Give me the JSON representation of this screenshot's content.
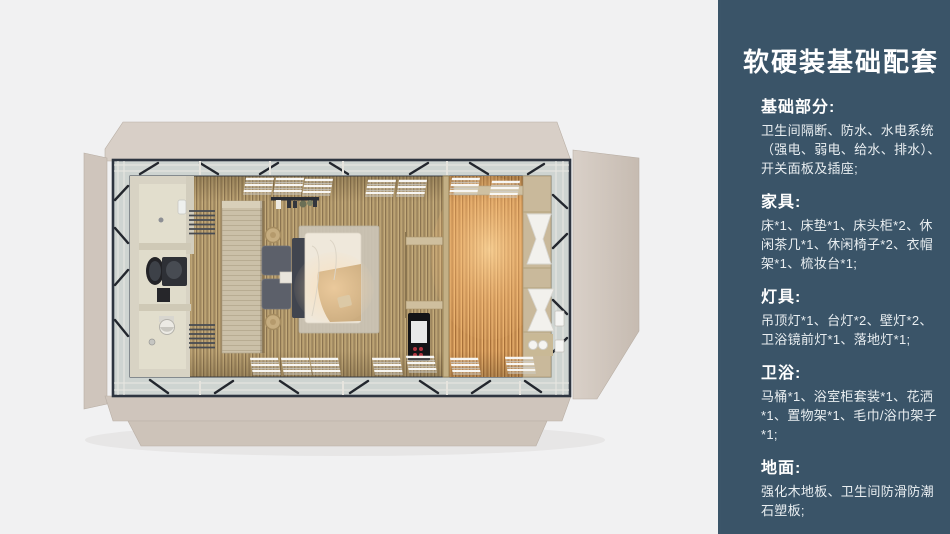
{
  "theme": {
    "canvas_bg": "#f1f1f2",
    "sidebar_bg": "#3a5468",
    "title_color": "#ffffff",
    "body_color": "#e9eef1",
    "flap_beige": "#d8cfc7",
    "flap_beige_dark": "#cfc5bc",
    "steel_frame": "#2e3540",
    "glass_band": "#ced4d1",
    "floor_wood": "#b1986a",
    "floor_warm": "#d0975a",
    "bathroom_wall": "#d8d3c4",
    "wardrobe_wood": "#cbc0a8",
    "bed_duvet": "#efe8db",
    "pillow_dark": "#5c606a",
    "curtain_white": "#f2f1ed"
  },
  "sidebar": {
    "title": "软硬装基础配套",
    "sections": [
      {
        "title": "基础部分:",
        "body": "卫生间隔断、防水、水电系统（强电、弱电、给水、排水）、开关面板及插座;"
      },
      {
        "title": "家具:",
        "body": "床*1、床垫*1、床头柜*2、休闲茶几*1、休闲椅子*2、衣帽架*1、梳妆台*1;"
      },
      {
        "title": "灯具:",
        "body": "吊顶灯*1、台灯*2、壁灯*2、卫浴镜前灯*1、落地灯*1;"
      },
      {
        "title": "卫浴:",
        "body": "马桶*1、浴室柜套装*1、花洒*1、置物架*1、毛巾/浴巾架子*1;"
      },
      {
        "title": "地面:",
        "body": "强化木地板、卫生间防滑防潮石塑板;"
      }
    ]
  }
}
